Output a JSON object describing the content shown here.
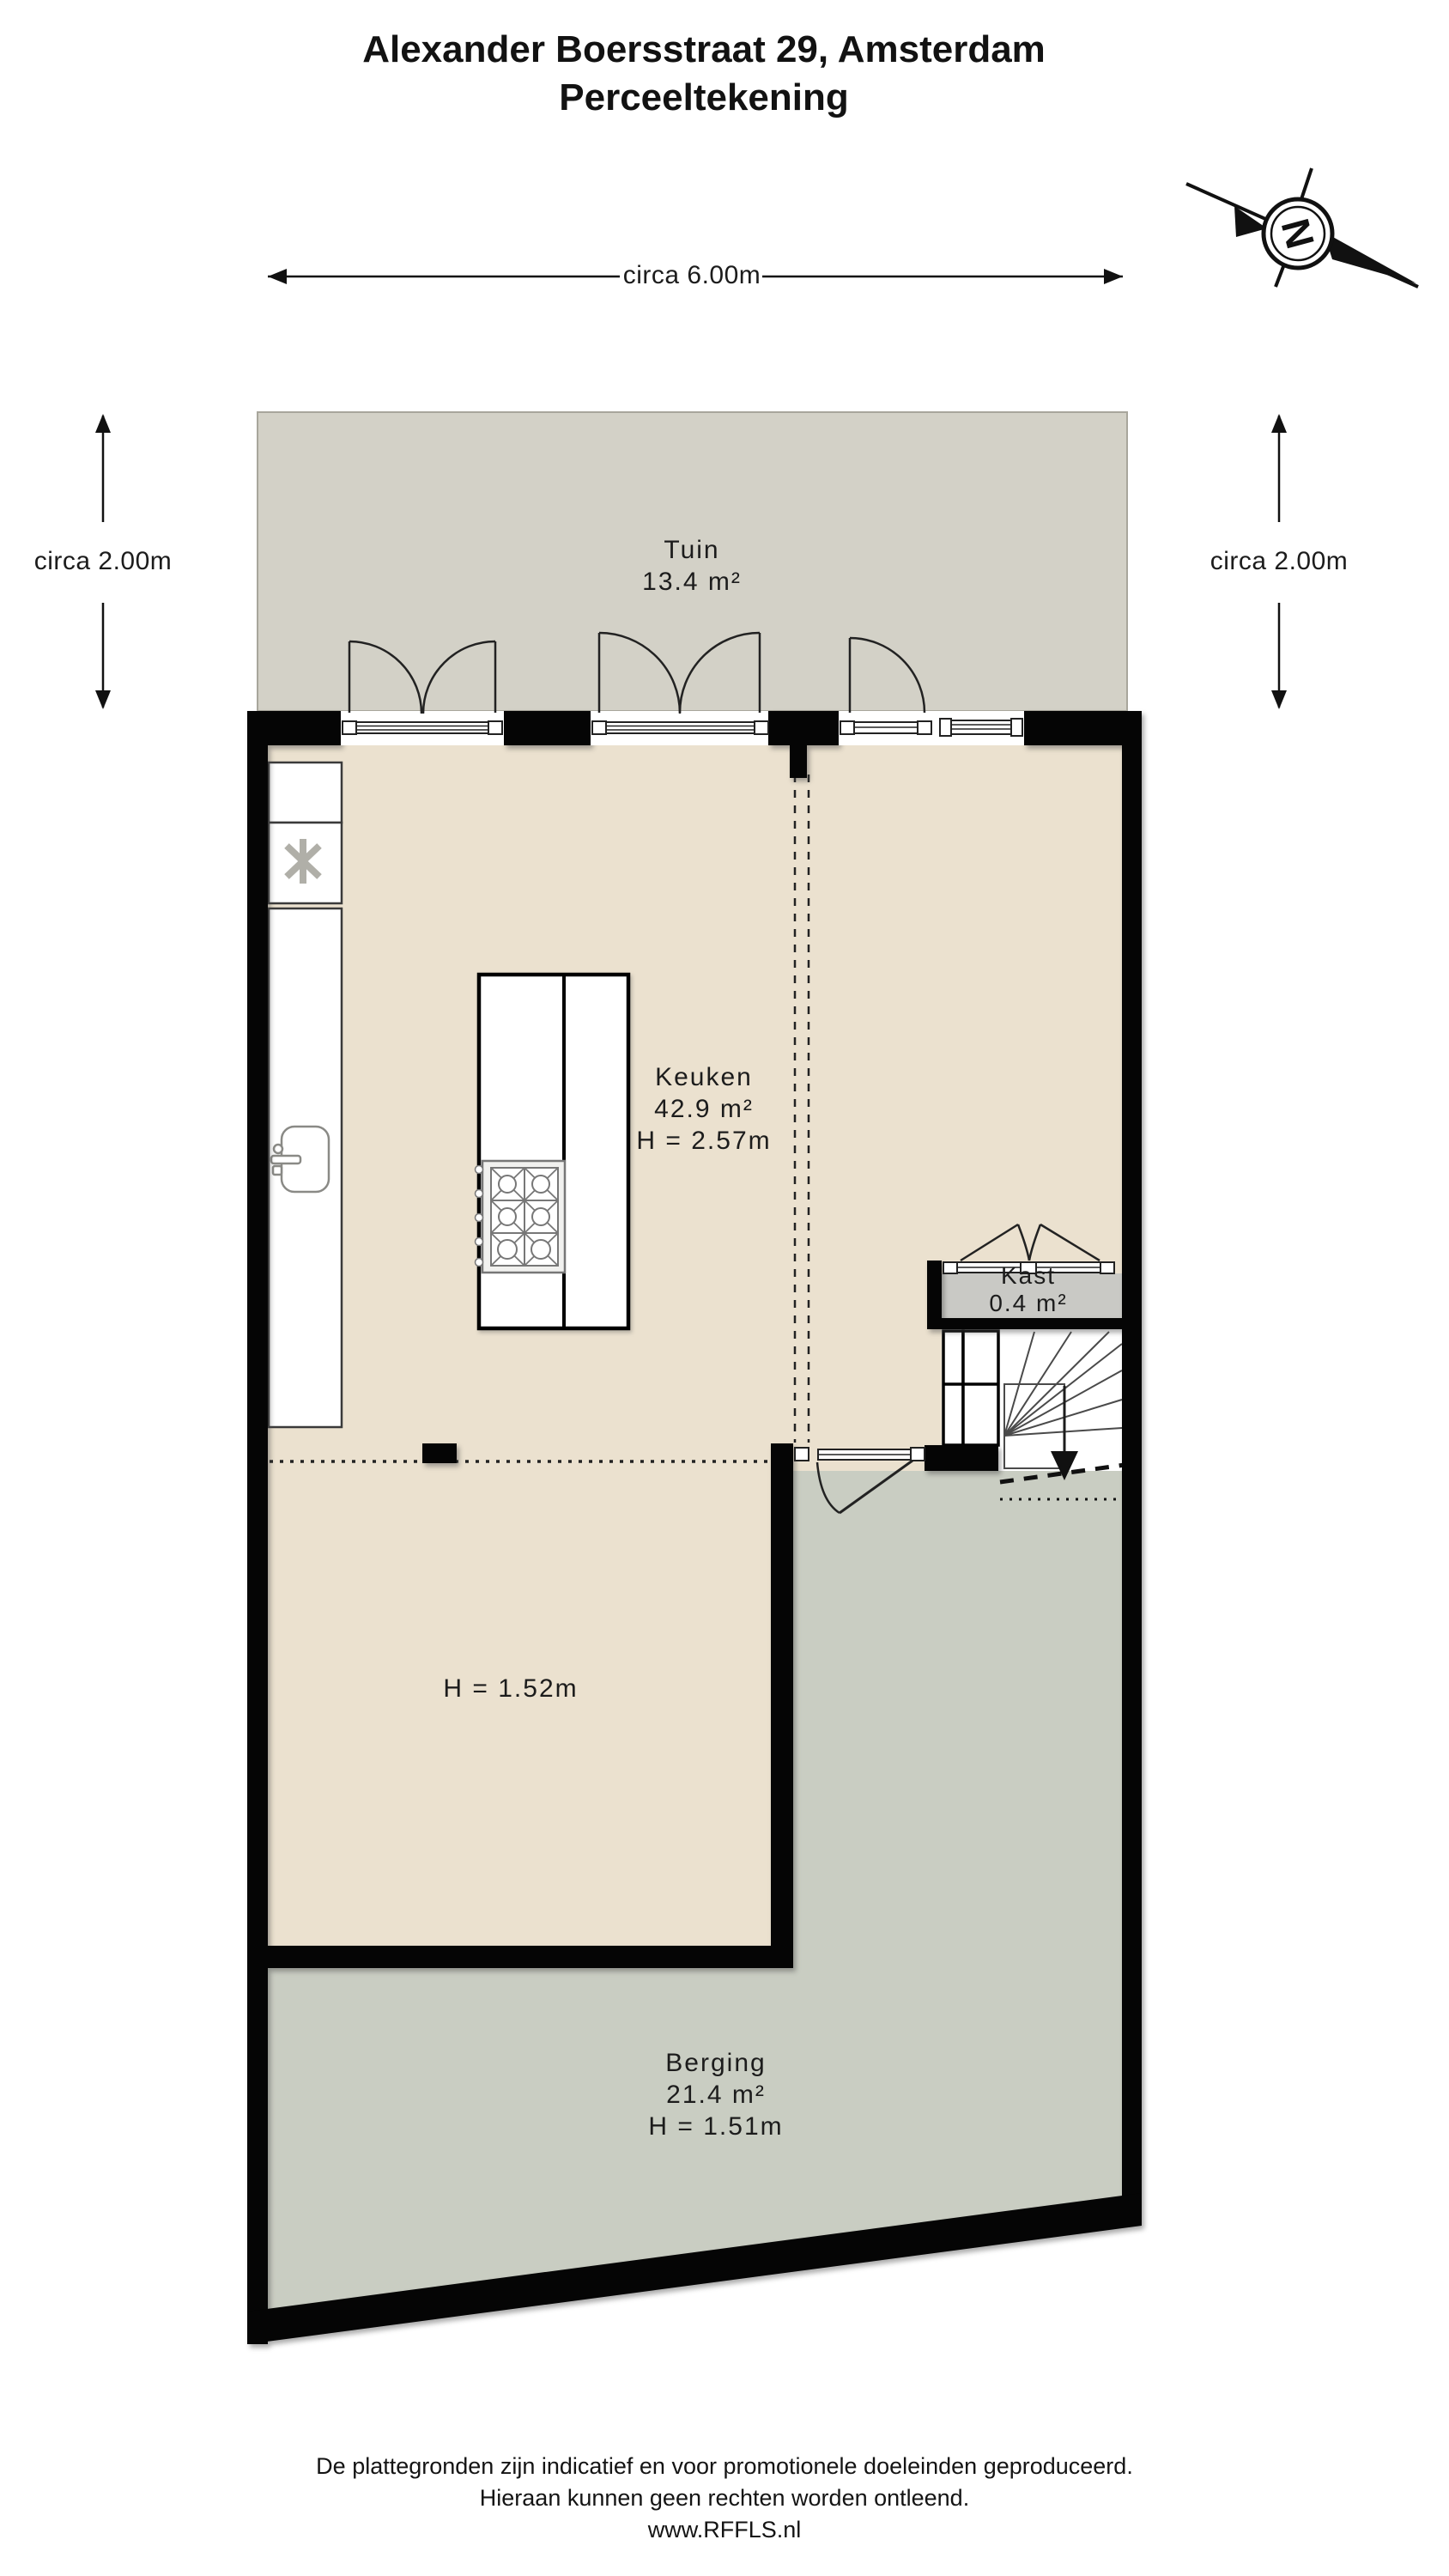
{
  "title": {
    "line1": "Alexander Boersstraat 29, Amsterdam",
    "line2": "Perceeltekening"
  },
  "compass": {
    "label": "N"
  },
  "dimensions": {
    "top_width": "circa 6.00m",
    "left_depth": "circa 2.00m",
    "right_depth": "circa 2.00m"
  },
  "rooms": {
    "tuin": {
      "name": "Tuin",
      "area": "13.4 m²"
    },
    "keuken": {
      "name": "Keuken",
      "area": "42.9 m²",
      "height": "H = 2.57m"
    },
    "kast": {
      "name": "Kast",
      "area": "0.4 m²"
    },
    "low_zone": {
      "height": "H = 1.52m"
    },
    "berging": {
      "name": "Berging",
      "area": "21.4 m²",
      "height": "H = 1.51m"
    }
  },
  "icons": {
    "compass": "north-arrow",
    "freezer": "snowflake",
    "stair_direction": "down-arrow"
  },
  "colors": {
    "interior_beige": "#ebe1cf",
    "garden_gray": "#d3d1c7",
    "berging_gray": "#c9cdc2",
    "kast_gray": "#c9c9c5",
    "wall_black": "#050505"
  },
  "footer": {
    "line1": "De plattegronden zijn indicatief en voor promotionele doeleinden geproduceerd.",
    "line2": "Hieraan kunnen geen rechten worden ontleend.",
    "line3": "www.RFFLS.nl"
  }
}
